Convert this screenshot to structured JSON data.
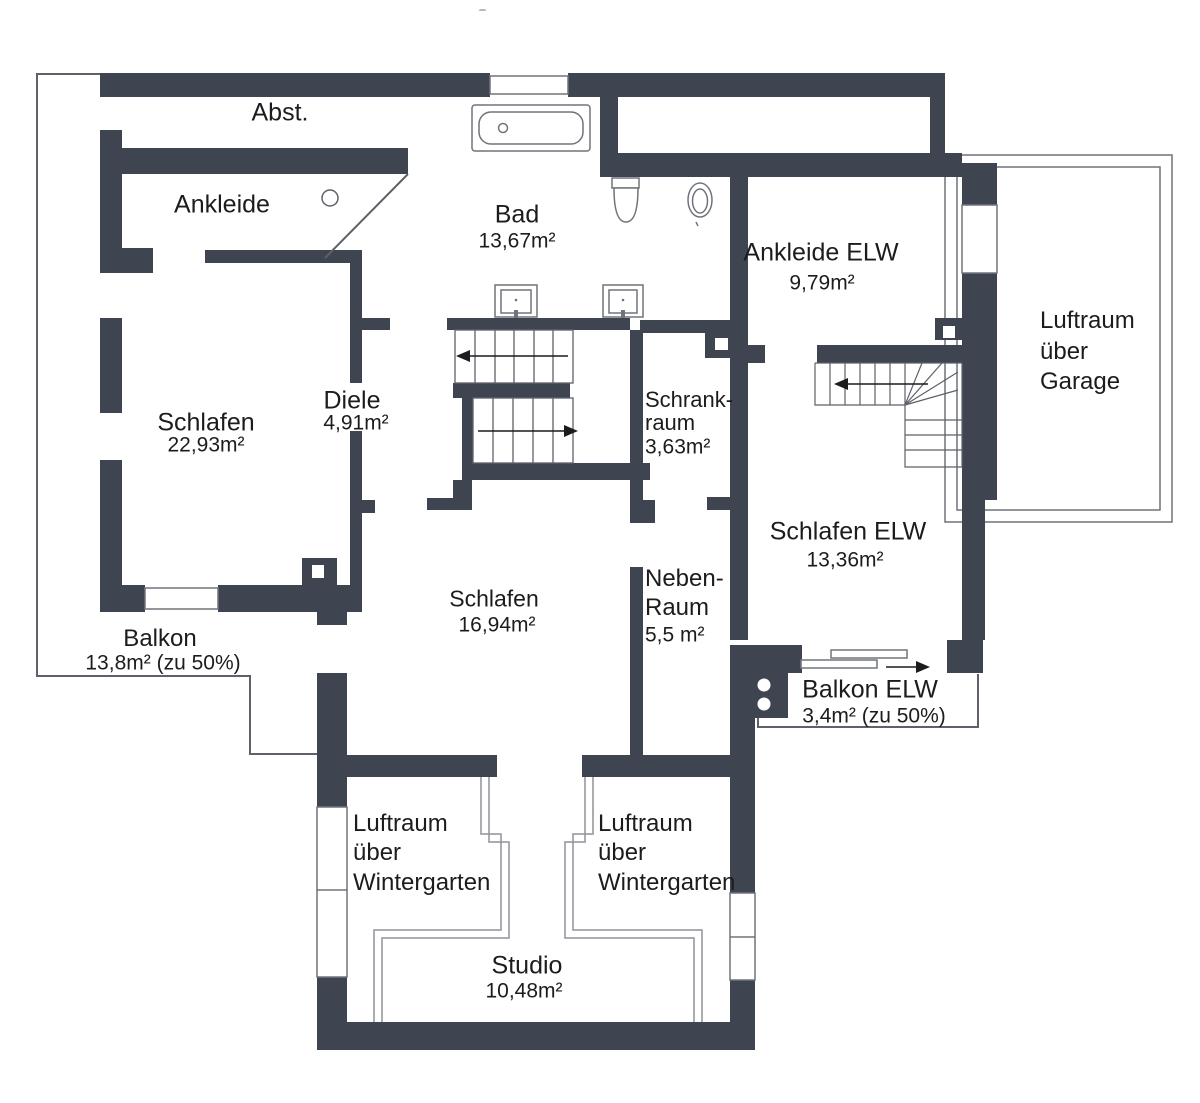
{
  "colors": {
    "wall": "#3e4550",
    "line": "#555a62",
    "thin": "#8f929a",
    "text": "#1c1c1e"
  },
  "rooms": {
    "abst": {
      "name": "Abst."
    },
    "ankleide": {
      "name": "Ankleide"
    },
    "bad": {
      "name": "Bad",
      "area": "13,67m²"
    },
    "ankleide_elw": {
      "name": "Ankleide ELW",
      "area": "9,79m²"
    },
    "luftraum_garage": {
      "line1": "Luftraum",
      "line2": "über",
      "line3": "Garage"
    },
    "schlafen": {
      "name": "Schlafen",
      "area": "22,93m²"
    },
    "diele": {
      "name": "Diele",
      "area": "4,91m²"
    },
    "schrankraum": {
      "line1": "Schrank-",
      "line2": "raum",
      "area": "3,63m²"
    },
    "schlafen_elw": {
      "name": "Schlafen ELW",
      "area": "13,36m²"
    },
    "neben_raum": {
      "line1": "Neben-",
      "line2": "Raum",
      "area": "5,5 m²"
    },
    "schlafen_mitte": {
      "name": "Schlafen",
      "area": "16,94m²"
    },
    "balkon": {
      "name": "Balkon",
      "area": "13,8m² (zu 50%)"
    },
    "balkon_elw": {
      "name": "Balkon ELW",
      "area": "3,4m² (zu 50%)"
    },
    "luftraum_wintergarten_links": {
      "line1": "Luftraum",
      "line2": "über",
      "line3": "Wintergarten"
    },
    "luftraum_wintergarten_rechts": {
      "line1": "Luftraum",
      "line2": "über",
      "line3": "Wintergarten"
    },
    "studio": {
      "name": "Studio",
      "area": "10,48m²"
    }
  },
  "fixtures": [
    "bathtub-icon",
    "toilet-icon",
    "bidet-icon",
    "washbasin-icon",
    "washbasin-icon",
    "main-staircase-icon",
    "elw-winder-staircase-icon",
    "sliding-door-icon",
    "chimney-icon",
    "door-swing-icon"
  ]
}
